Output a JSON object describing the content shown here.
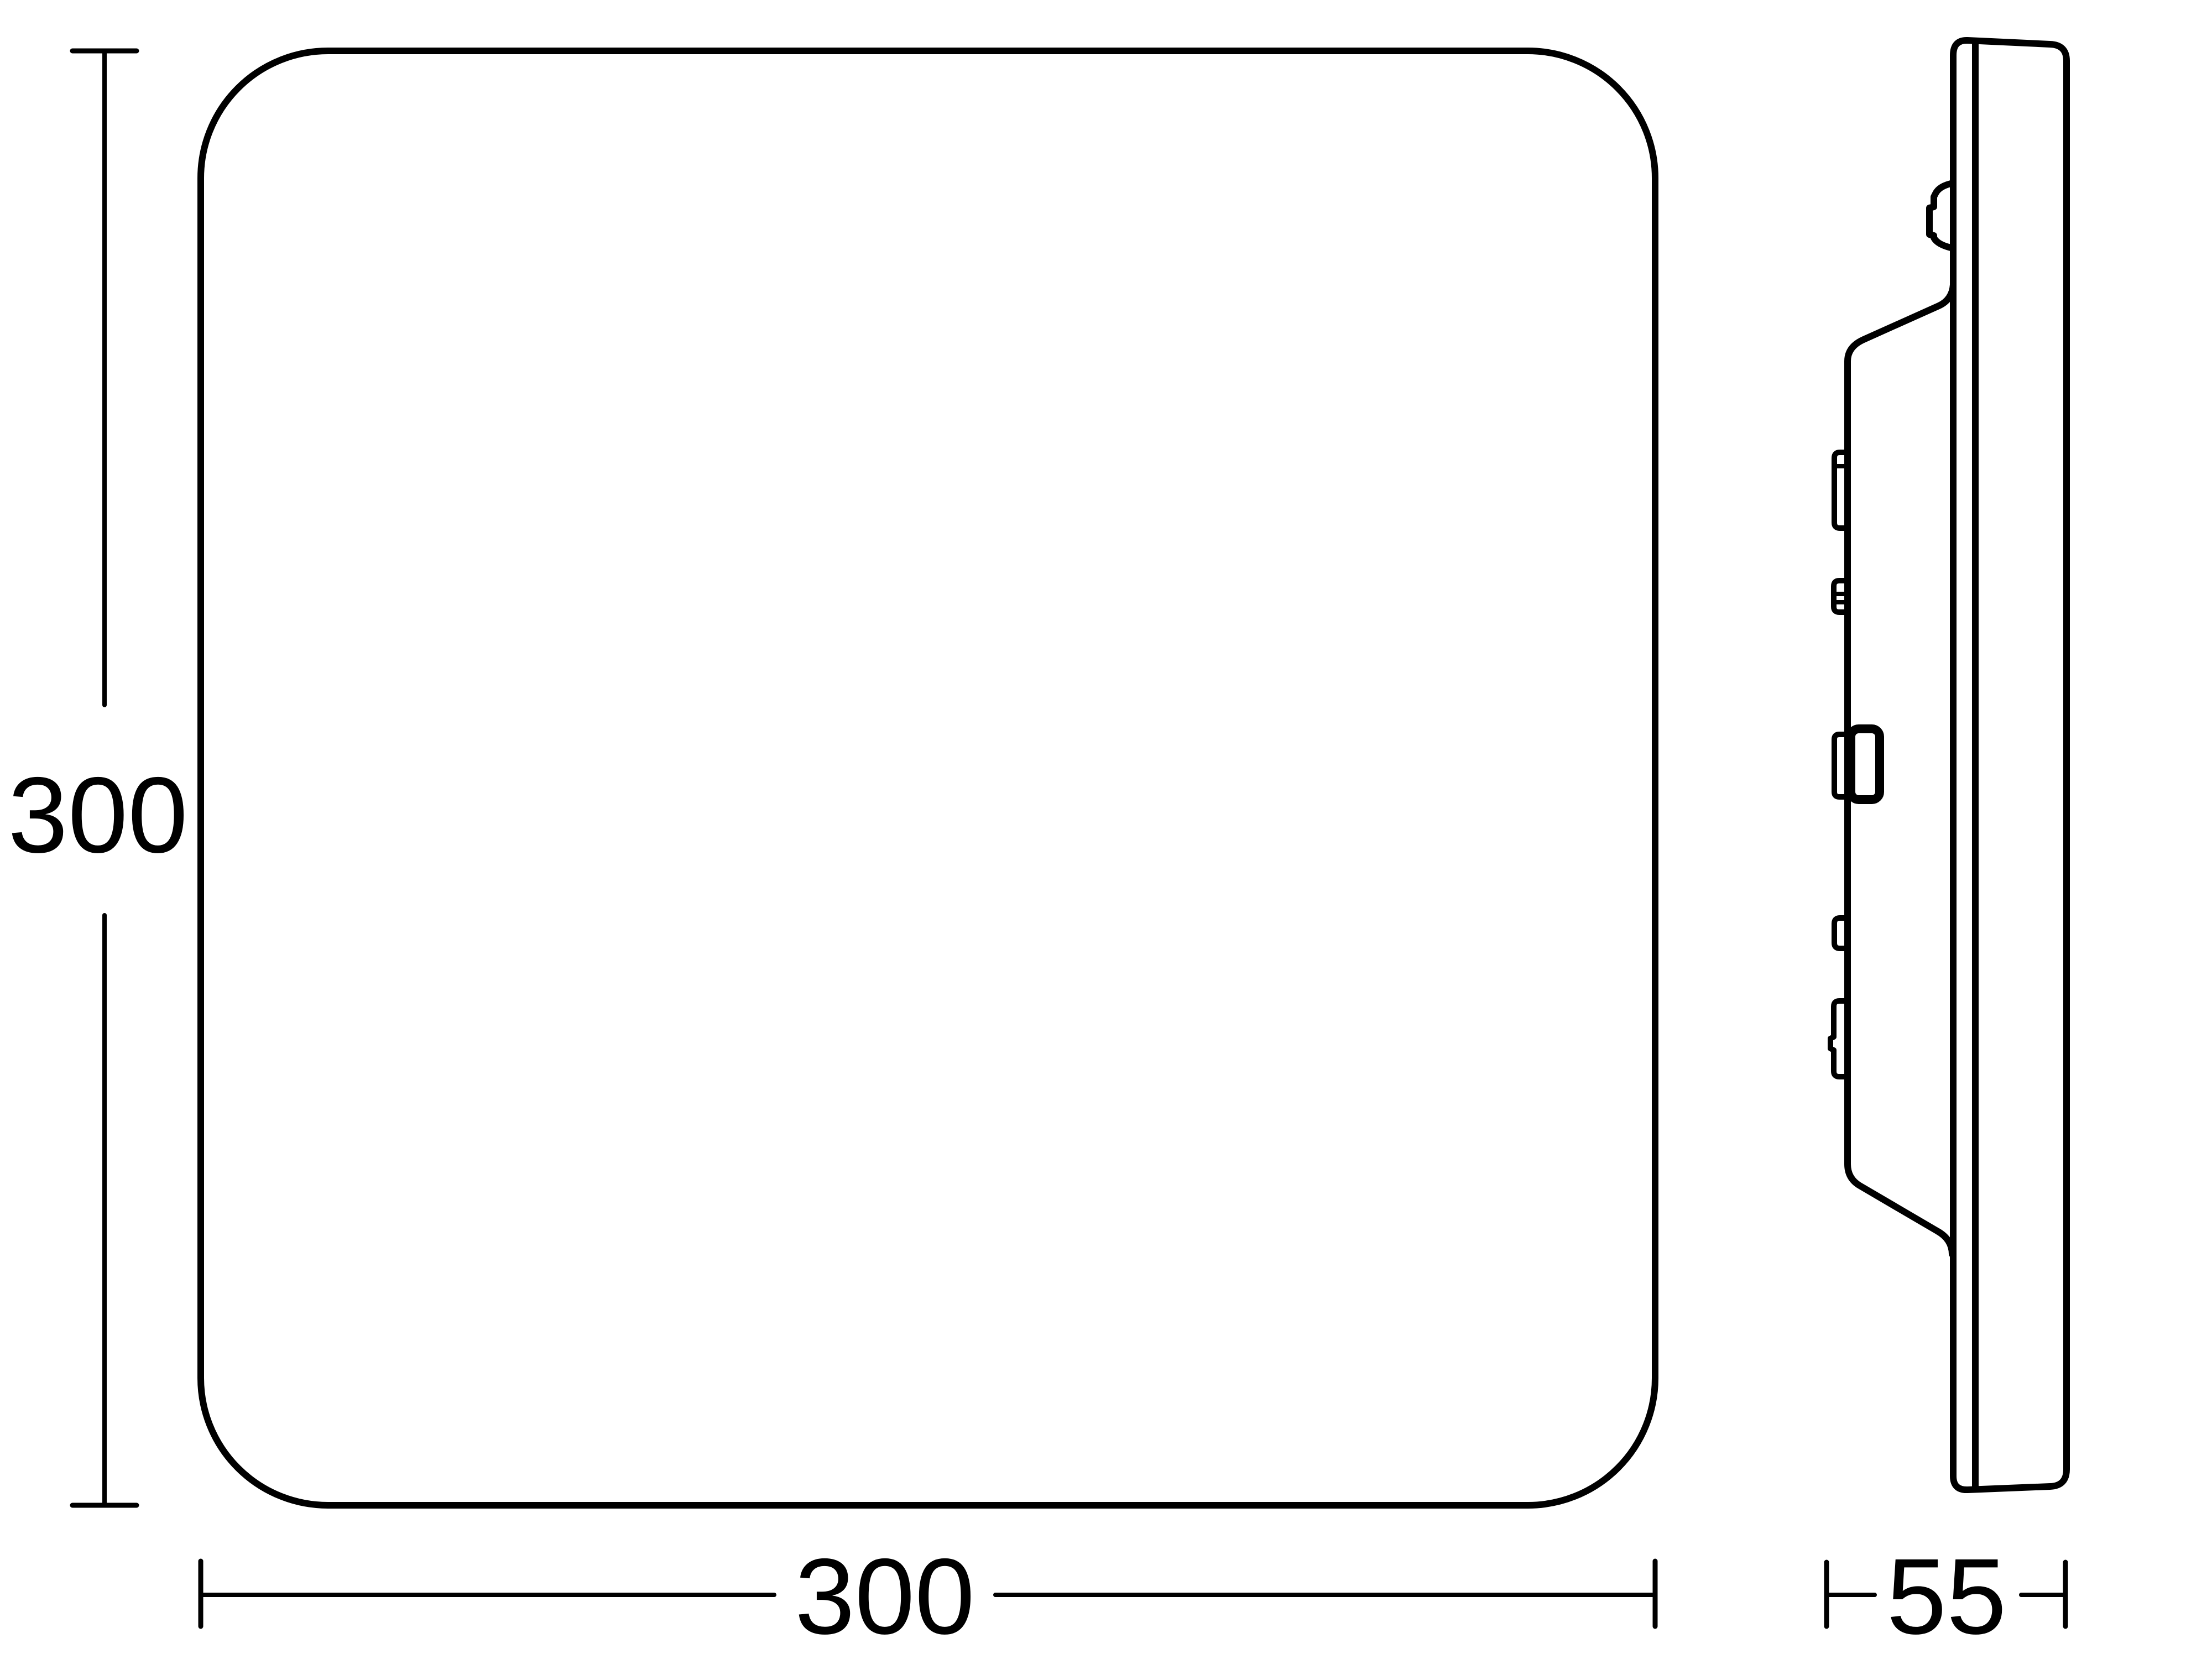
{
  "colors": {
    "line": "#000000",
    "background": "#ffffff"
  },
  "dimensions": {
    "height_label": "300",
    "width_label": "300",
    "depth_label": "55"
  }
}
